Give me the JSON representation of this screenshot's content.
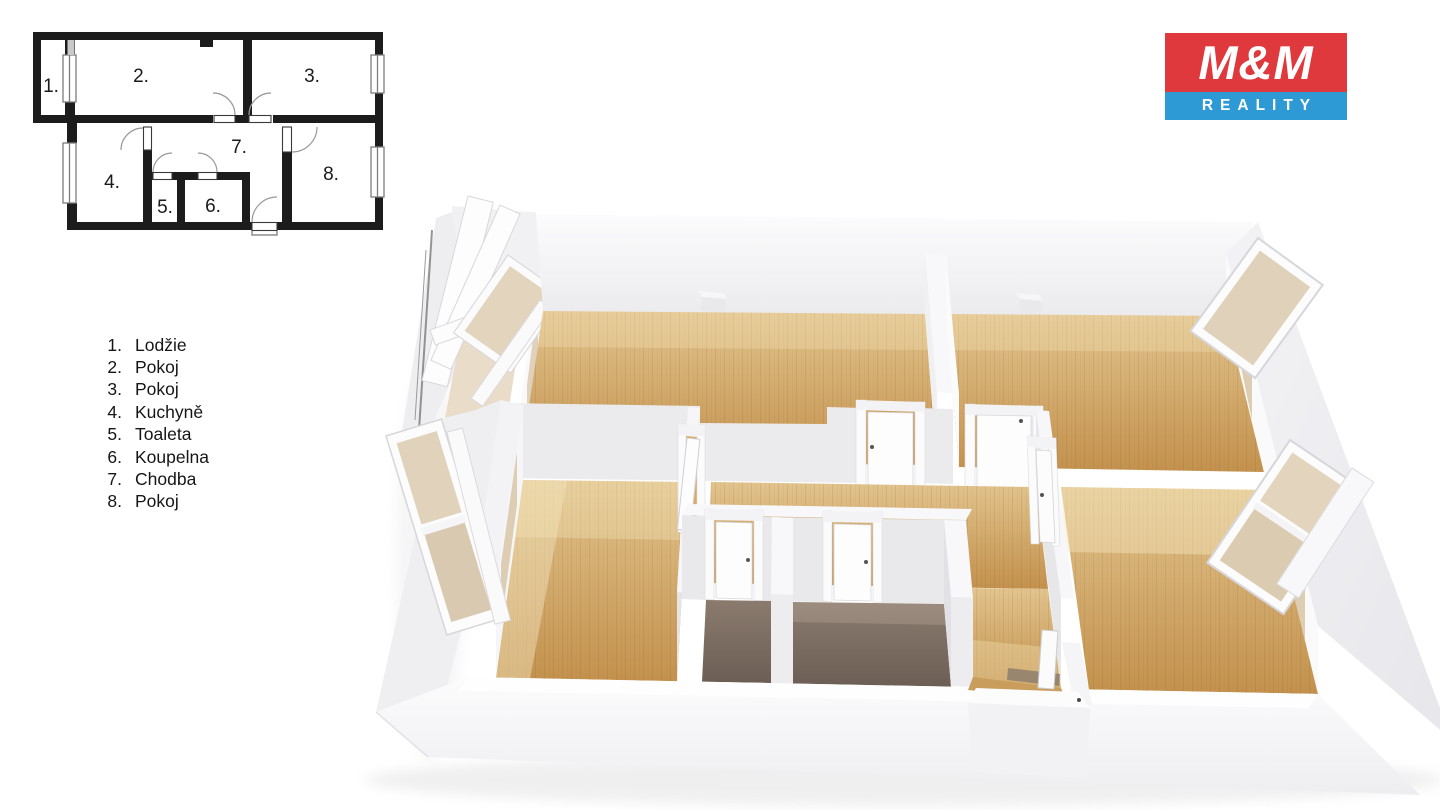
{
  "logo": {
    "top_text": "M&M",
    "bottom_text": "REALITY"
  },
  "legend": {
    "items": [
      {
        "num": "1.",
        "label": "Lodžie"
      },
      {
        "num": "2.",
        "label": "Pokoj"
      },
      {
        "num": "3.",
        "label": "Pokoj"
      },
      {
        "num": "4.",
        "label": "Kuchyně"
      },
      {
        "num": "5.",
        "label": "Toaleta"
      },
      {
        "num": "6.",
        "label": "Koupelna"
      },
      {
        "num": "7.",
        "label": "Chodba"
      },
      {
        "num": "8.",
        "label": "Pokoj"
      }
    ]
  },
  "plan2d": {
    "labels": [
      "1.",
      "2.",
      "3.",
      "4.",
      "5.",
      "6.",
      "7.",
      "8."
    ]
  },
  "colors": {
    "logo_red": "#e0393d",
    "logo_blue": "#2e9ad5",
    "wall_black": "#1c1c1c",
    "wood_light": "#e2c48e",
    "wood_dark": "#c3914d",
    "wood_band": "#f4e4ba",
    "floor_dark_back": "#8b7b6f",
    "floor_dark_front": "#6c5e54",
    "glass": "#ddcdb3",
    "loggia_floor": "#e9dcc8"
  }
}
